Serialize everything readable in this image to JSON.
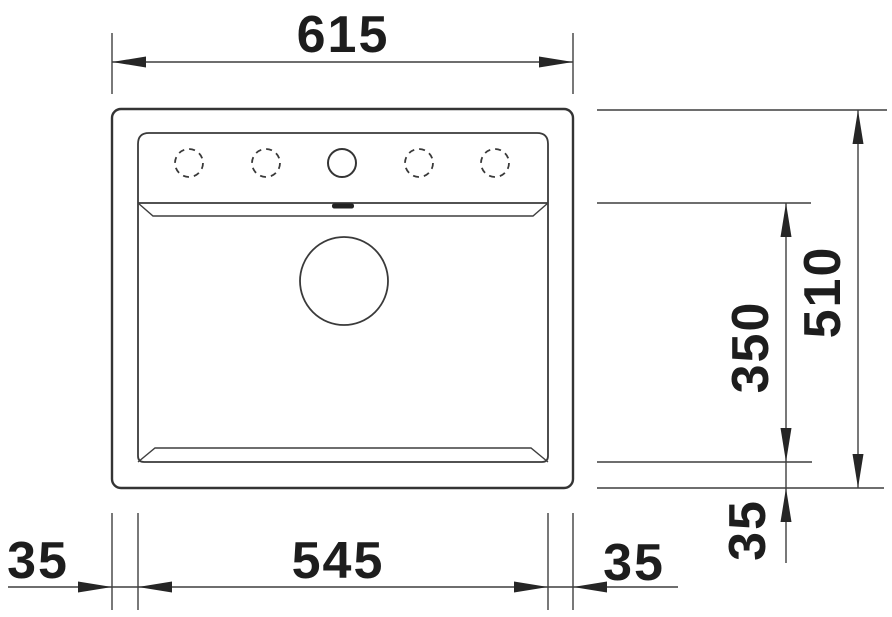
{
  "drawing": {
    "title": "sink-top-view-dimension-drawing",
    "labels": {
      "overall_width": "615",
      "overall_depth": "510",
      "bowl_depth": "350",
      "bowl_width": "545",
      "rim_left": "35",
      "rim_right": "35",
      "rim_front": "35"
    },
    "features": {
      "tap_holes": [
        "dashed",
        "dashed",
        "solid",
        "dashed",
        "dashed"
      ],
      "drain_count": 1,
      "overflow_slot_count": 1
    },
    "colors": {
      "line": "#3a3a3a",
      "text": "#1d1d1d",
      "background": "#ffffff"
    }
  }
}
